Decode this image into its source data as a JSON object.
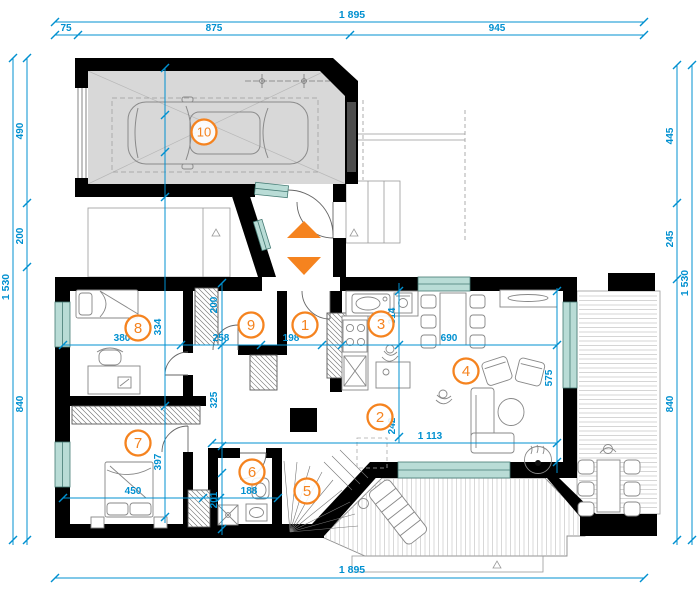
{
  "title": "House ground floor plan",
  "colors": {
    "dimension_blue": "#0090d0",
    "accent_orange": "#f5831f",
    "wall_black": "#000000",
    "window_teal": "#b9dcd6",
    "garage_floor_gray": "#d8d8d8"
  },
  "dimensions": {
    "top": {
      "total": "1 895",
      "segments": [
        "75",
        "875",
        "945"
      ]
    },
    "left": {
      "total": "1 530",
      "segments": [
        "490",
        "200",
        "840"
      ]
    },
    "right": {
      "total": "1 530",
      "segments": [
        "445",
        "245",
        "840"
      ]
    },
    "bottom": {
      "total": "1 895"
    },
    "interior": {
      "v380": "380",
      "v334": "334",
      "v258": "258",
      "v198": "198",
      "v200": "200",
      "v314": "314",
      "v690": "690",
      "v575": "575",
      "v1113": "1 113",
      "v242": "242",
      "v325": "325",
      "v397": "397",
      "v450": "450",
      "v201": "201",
      "v188": "188"
    }
  },
  "rooms": [
    {
      "number": "1"
    },
    {
      "number": "2"
    },
    {
      "number": "3"
    },
    {
      "number": "4"
    },
    {
      "number": "5"
    },
    {
      "number": "6"
    },
    {
      "number": "7"
    },
    {
      "number": "8"
    },
    {
      "number": "9"
    },
    {
      "number": "10"
    }
  ]
}
